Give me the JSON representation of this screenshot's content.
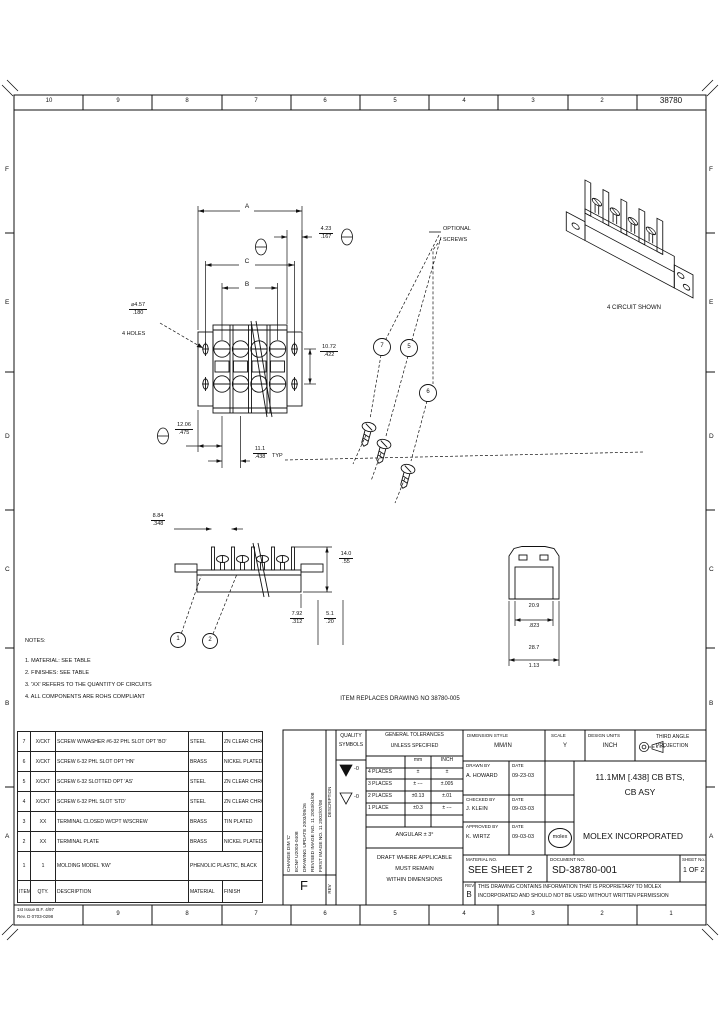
{
  "sheet": {
    "drawing_number": "38780",
    "ink_color": "#111111",
    "zones_top": [
      "10",
      "9",
      "8",
      "7",
      "6",
      "5",
      "4",
      "3",
      "2"
    ],
    "zones_bottom": [
      "9",
      "8",
      "7",
      "6",
      "5",
      "4",
      "3",
      "2",
      "1"
    ],
    "zone_letters": [
      "F",
      "E",
      "D",
      "C",
      "B",
      "A"
    ],
    "issue_line1": "1st Issue B.F. 4/97",
    "issue_line2": "Rev. D 0703-0298"
  },
  "views": {
    "iso_caption": "4 CIRCUIT SHOWN",
    "optional_screws_line1": "OPTIONAL",
    "optional_screws_line2": "SCREWS",
    "replaces_note": "ITEM REPLACES DRAWING NO 38780-005"
  },
  "notes": {
    "heading": "NOTES:",
    "items": [
      "1. MATERIAL: SEE TABLE",
      "2. FINISHES: SEE TABLE",
      "3. 'XX' REFERS TO THE QUANTITY OF CIRCUITS",
      "4. ALL COMPONENTS ARE ROHS COMPLIANT"
    ]
  },
  "dims": {
    "a": "A",
    "b": "B",
    "c": "C",
    "d1": {
      "mm": "4.23",
      "in": ".167"
    },
    "d2": {
      "mm": "10.72",
      "in": ".422"
    },
    "holes": {
      "mm": "⌀4.57",
      "in": ".180",
      "note": "4 HOLES"
    },
    "d3": {
      "mm": "12.06",
      "in": ".475"
    },
    "pitch": {
      "mm": "11.1",
      "in": ".438",
      "suffix": "TYP"
    },
    "d4": {
      "mm": "8.84",
      "in": ".348"
    },
    "d5": {
      "mm": "14.0",
      "in": ".55"
    },
    "d6": {
      "mm": "7.92",
      "in": ".312"
    },
    "d7": {
      "mm": "5.1",
      "in": ".20"
    },
    "d8": {
      "mm": "20.9",
      "in": ".823"
    },
    "d9": {
      "mm": "28.7",
      "in": "1.13"
    }
  },
  "balloons": {
    "b1": "1",
    "b2": "2",
    "s7": "7",
    "s5": "5",
    "s6": "6"
  },
  "parts_table": {
    "headers": [
      "ITEM",
      "QTY.",
      "DESCRIPTION",
      "MATERIAL",
      "FINISH"
    ],
    "rows": [
      {
        "item": "7",
        "qty": "X/CKT",
        "desc": "SCREW W/WASHER #6-32 PHL SLOT OPT 'BO'",
        "material": "STEEL",
        "finish": "ZN CLEAR CHROMATE"
      },
      {
        "item": "6",
        "qty": "X/CKT",
        "desc": "SCREW 6-32 PHL SLOT OPT 'HN'",
        "material": "BRASS",
        "finish": "NICKEL PLATED"
      },
      {
        "item": "5",
        "qty": "X/CKT",
        "desc": "SCREW 6-32 SLOTTED OPT 'AS'",
        "material": "STEEL",
        "finish": "ZN CLEAR CHROMATE"
      },
      {
        "item": "4",
        "qty": "X/CKT",
        "desc": "SCREW 6-32 PHL SLOT 'STD'",
        "material": "STEEL",
        "finish": "ZN CLEAR CHROMATE"
      },
      {
        "item": "3",
        "qty": "XX",
        "desc": "TERMINAL CLOSED W/CPT W/SCREW",
        "material": "BRASS",
        "finish": "TIN PLATED"
      },
      {
        "item": "2",
        "qty": "XX",
        "desc": "TERMINAL PLATE",
        "material": "BRASS",
        "finish": "NICKEL PLATED"
      },
      {
        "item": "1",
        "qty": "1",
        "desc": "MOLDING MODEL 'KW'",
        "material": "PHENOLIC PLASTIC, BLACK",
        "finish": ""
      }
    ]
  },
  "revision_block": {
    "entries": [
      "CHANGE DIM 'C'",
      "ECN# U2003-0408",
      "DRAWING UPDATE  2003/09/26",
      "REVISED IMAGE NO. 11  2003/04/08",
      "FIRST IMAGE NO. 11  2002/07/08"
    ],
    "rev_letter": "F",
    "description_label": "DESCRIPTION",
    "rev_label": "REV"
  },
  "quality": {
    "heading_line1": "QUALITY",
    "heading_line2": "SYMBOLS",
    "suffix": "-0"
  },
  "tolerances": {
    "title_line1": "GENERAL TOLERANCES",
    "title_line2": "UNLESS SPECIFIED",
    "col_mm": "mm",
    "col_inch": "INCH",
    "rows": [
      {
        "label": "4 PLACES",
        "mm": "±",
        "inch": "±"
      },
      {
        "label": "3 PLACES",
        "mm": "± ---",
        "inch": "±.005"
      },
      {
        "label": "2 PLACES",
        "mm": "±0.13",
        "inch": "±.01"
      },
      {
        "label": "1 PLACE",
        "mm": "±0.3",
        "inch": "± ---"
      }
    ],
    "angular": "ANGULAR ± 3°",
    "draft_line1": "DRAFT WHERE APPLICABLE",
    "draft_line2": "MUST REMAIN",
    "draft_line3": "WITHIN DIMENSIONS"
  },
  "title_block": {
    "dimension_style_label": "DIMENSION STYLE",
    "dimension_style": "MM/IN",
    "scale_label": "SCALE",
    "scale": "Y",
    "design_units_label": "DESIGN UNITS",
    "design_units": "INCH",
    "projection_line1": "THIRD ANGLE",
    "projection_line2": "PROJECTION",
    "drawn_label": "DRAWN BY",
    "drawn_by": "A. HOWARD",
    "drawn_date": "09-23-03",
    "checked_label": "CHECKED BY",
    "checked_by": "J. KLEIN",
    "checked_date": "09-03-03",
    "approved_label": "APPROVED BY",
    "approved_by": "K. WIRTZ",
    "approved_date": "09-03-03",
    "date_label": "DATE",
    "title_line1": "11.1MM [.438] CB BTS,",
    "title_line2": "CB ASY",
    "logo_text": "molex",
    "company": "MOLEX INCORPORATED",
    "material_label": "MATERIAL NO.",
    "material": "SEE SHEET 2",
    "document_label": "DOCUMENT NO.",
    "document": "SD-38780-001",
    "sheet_label": "SHEET No.",
    "sheet": "1 OF 2",
    "rev_label": "REV",
    "rev": "B",
    "proprietary_line1": "THIS DRAWING CONTAINS INFORMATION THAT IS PROPRIETARY TO MOLEX",
    "proprietary_line2": "INCORPORATED AND SHOULD NOT BE USED WITHOUT WRITTEN PERMISSION"
  }
}
